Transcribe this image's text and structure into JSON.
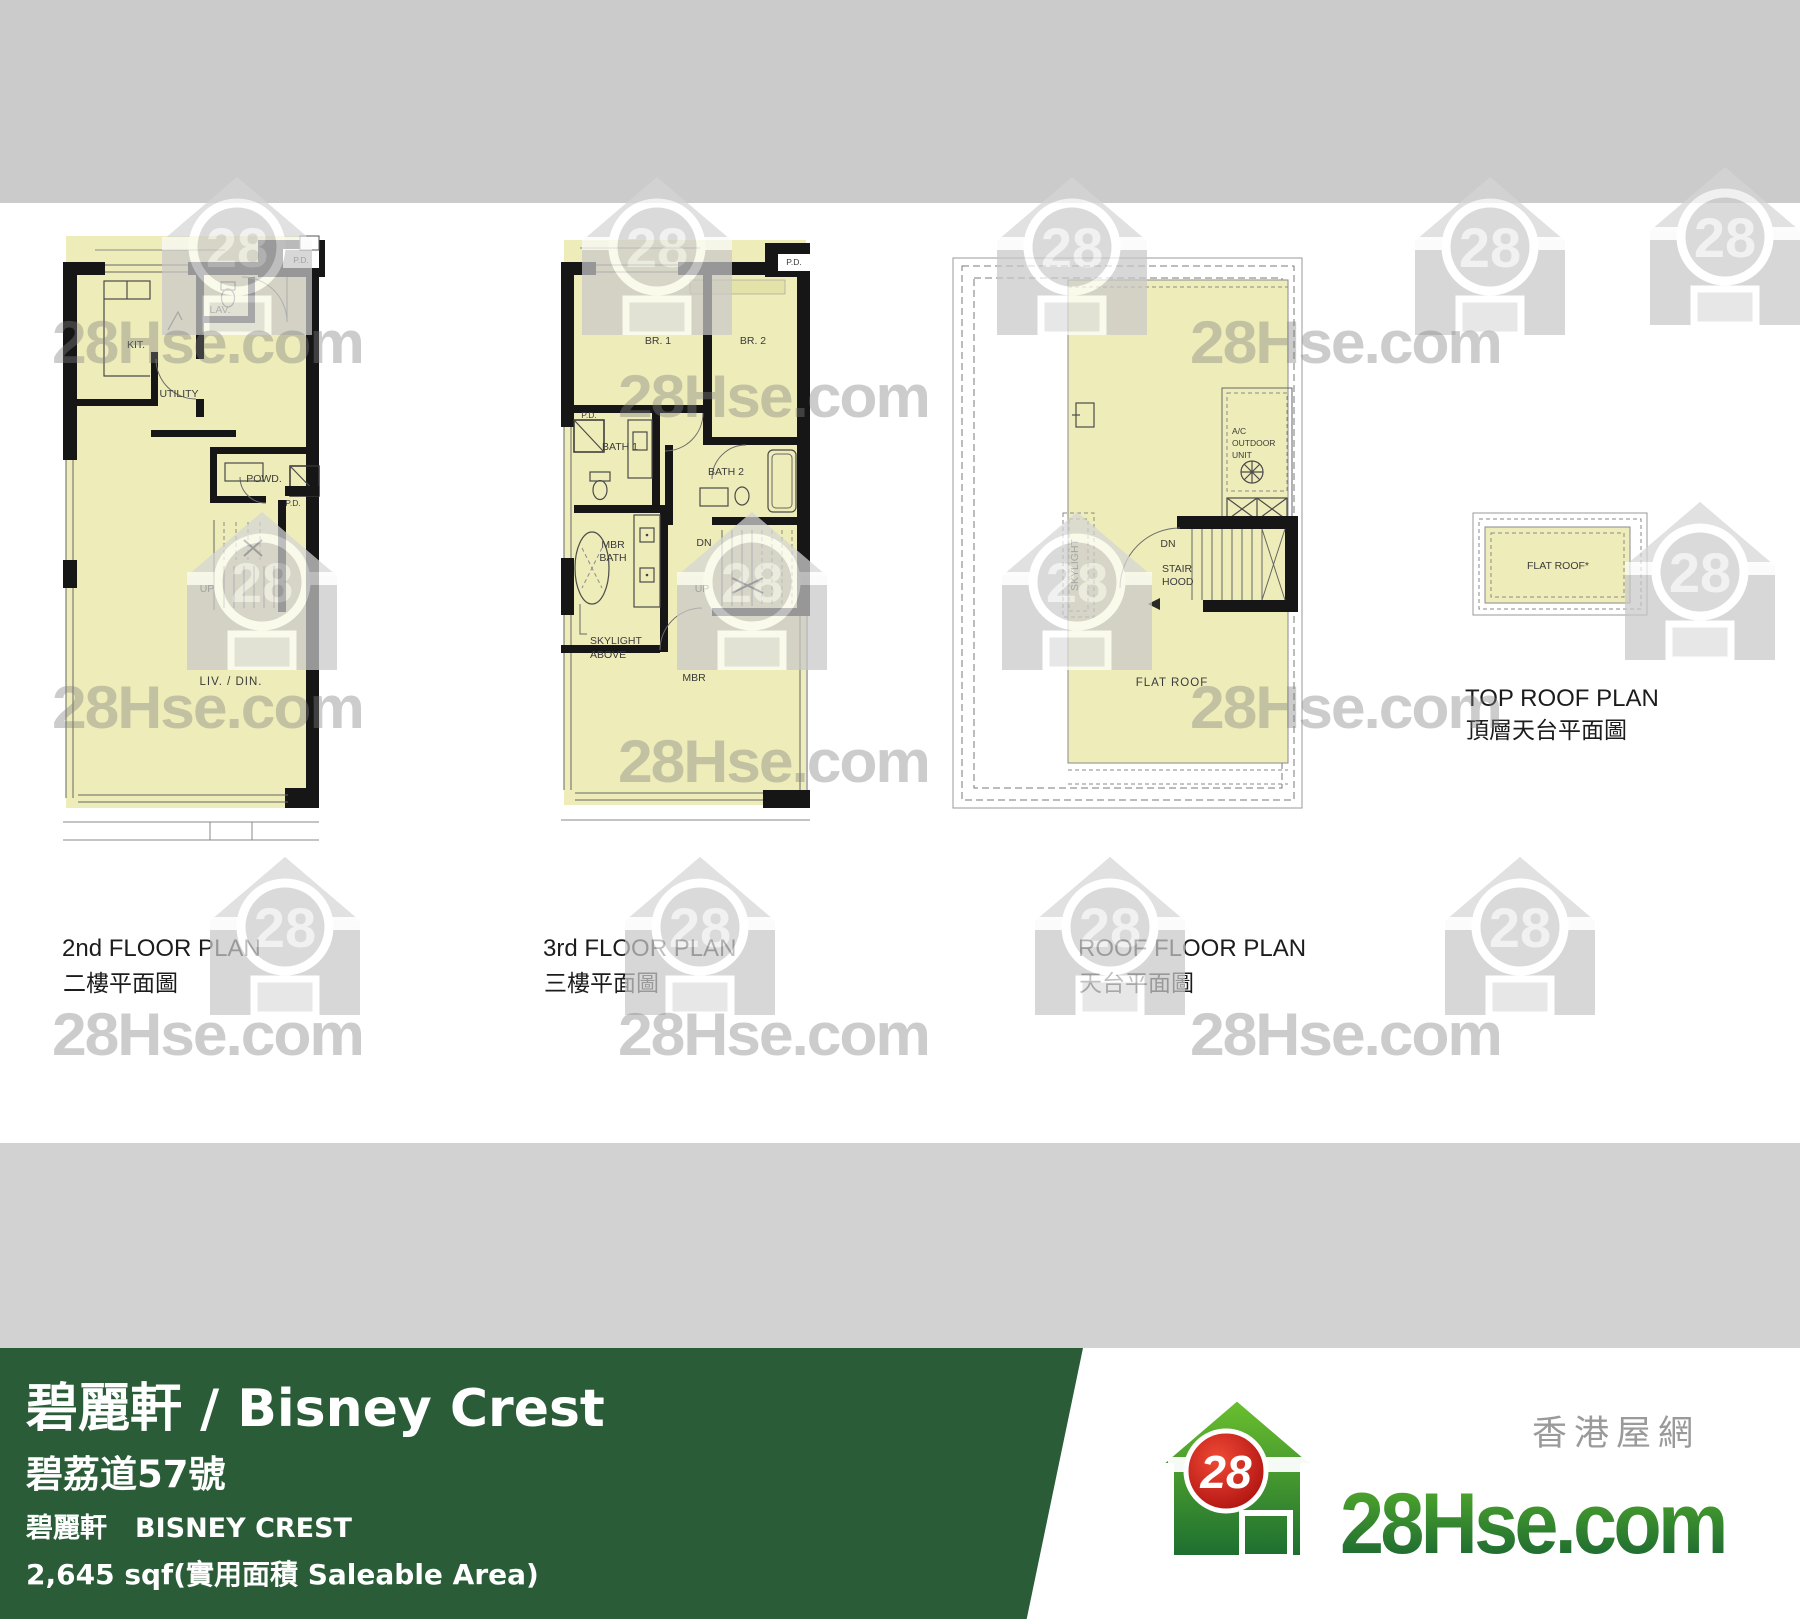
{
  "watermark": {
    "brand": "28Hse.com",
    "badge": "28"
  },
  "plans": {
    "p1": {
      "caption_en": "2nd FLOOR PLAN",
      "caption_zh": "二樓平面圖",
      "labels": {
        "pd_top": "P.D.",
        "lav": "LAV.",
        "kit": "KIT.",
        "utility": "UTILITY",
        "powd": "POWD.",
        "pd_mid": "P.D.",
        "up": "UP",
        "liv_din": "LIV.  /  DIN."
      }
    },
    "p2": {
      "caption_en": "3rd FLOOR PLAN",
      "caption_zh": "三樓平面圖",
      "labels": {
        "pd_top": "P.D.",
        "br1": "BR. 1",
        "br2": "BR. 2",
        "pd_left": "P.D.",
        "bath1": "BATH 1",
        "bath2": "BATH 2",
        "mbr_bath_l1": "MBR",
        "mbr_bath_l2": "BATH",
        "dn": "DN",
        "up": "UP",
        "skylight_l1": "SKYLIGHT",
        "skylight_l2": "ABOVE",
        "mbr": "MBR"
      }
    },
    "p3": {
      "caption_en": "ROOF FLOOR PLAN",
      "caption_zh": "天台平面圖",
      "labels": {
        "ac_l1": "A/C",
        "ac_l2": "OUTDOOR",
        "ac_l3": "UNIT",
        "dn": "DN",
        "stair_l1": "STAIR",
        "stair_l2": "HOOD",
        "skylight": "SKYLIGHT",
        "flat_roof": "FLAT  ROOF"
      }
    },
    "p4": {
      "caption_en": "TOP ROOF PLAN",
      "caption_zh": "頂層天台平面圖",
      "labels": {
        "flat_roof": "FLAT  ROOF*"
      }
    }
  },
  "banner": {
    "title": "碧麗軒 / Bisney Crest",
    "address": "碧荔道57號",
    "name_zh": "碧麗軒",
    "name_en": "BISNEY CREST",
    "area": "2,645 sqf(實用面積 Saleable Area)"
  },
  "brand": {
    "logo_text": "28Hse.com",
    "badge": "28",
    "tagline": "香港屋網"
  },
  "colors": {
    "banner_green": "#2a5c38",
    "plan_fill": "#eeedba",
    "band_top": "#cbcbcb",
    "band_mid": "#d2d2d2",
    "logo_red": "#c41414",
    "logo_green": "#2f9235"
  }
}
